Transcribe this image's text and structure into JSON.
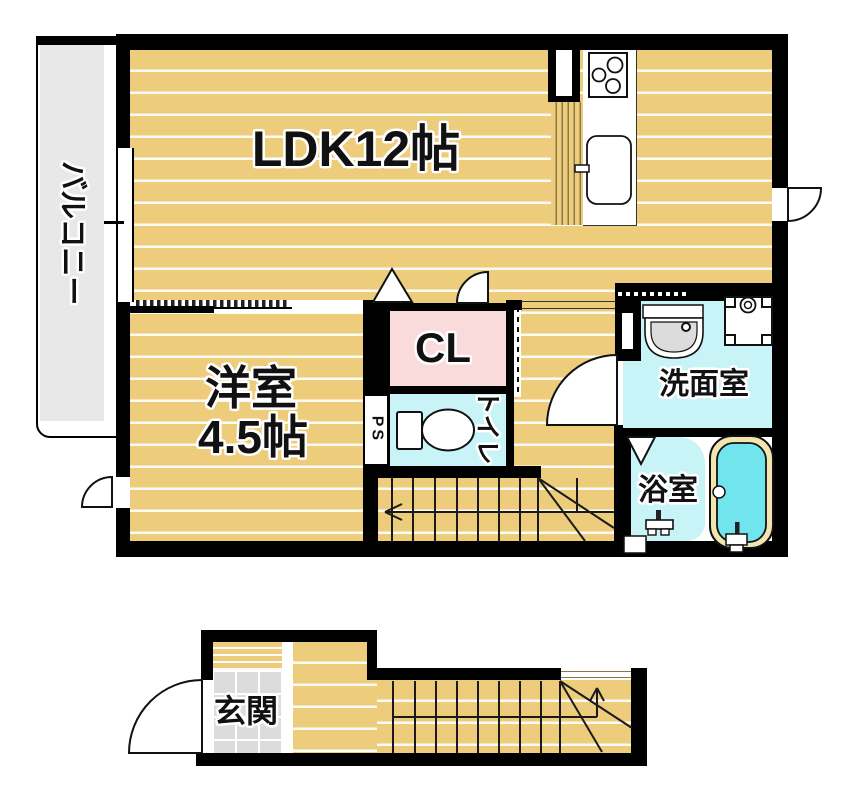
{
  "floorplan": {
    "rooms": {
      "balcony": {
        "label": "バルコニー"
      },
      "ldk": {
        "label": "LDK12帖"
      },
      "western_room": {
        "label": "洋室",
        "size_label": "4.5帖"
      },
      "closet": {
        "label": "CL"
      },
      "pipe_space": {
        "label": "PS"
      },
      "toilet": {
        "label": "トイレ"
      },
      "washroom": {
        "label": "洗面室"
      },
      "bathroom": {
        "label": "浴室"
      },
      "entrance": {
        "label": "玄関"
      }
    },
    "colors": {
      "floor_tan": "#edcd7c",
      "closet_pink": "#fadbdc",
      "wet_room_cyan": "#c9f4f7",
      "tub_water_cyan": "#70e5ee",
      "tub_rim_cream": "#f1e5b0",
      "balcony_gray": "#e8e8e8",
      "entrance_tile_gray": "#dcdcdc",
      "step_edge_brown": "#9c8649",
      "wall_black": "#000000"
    }
  }
}
